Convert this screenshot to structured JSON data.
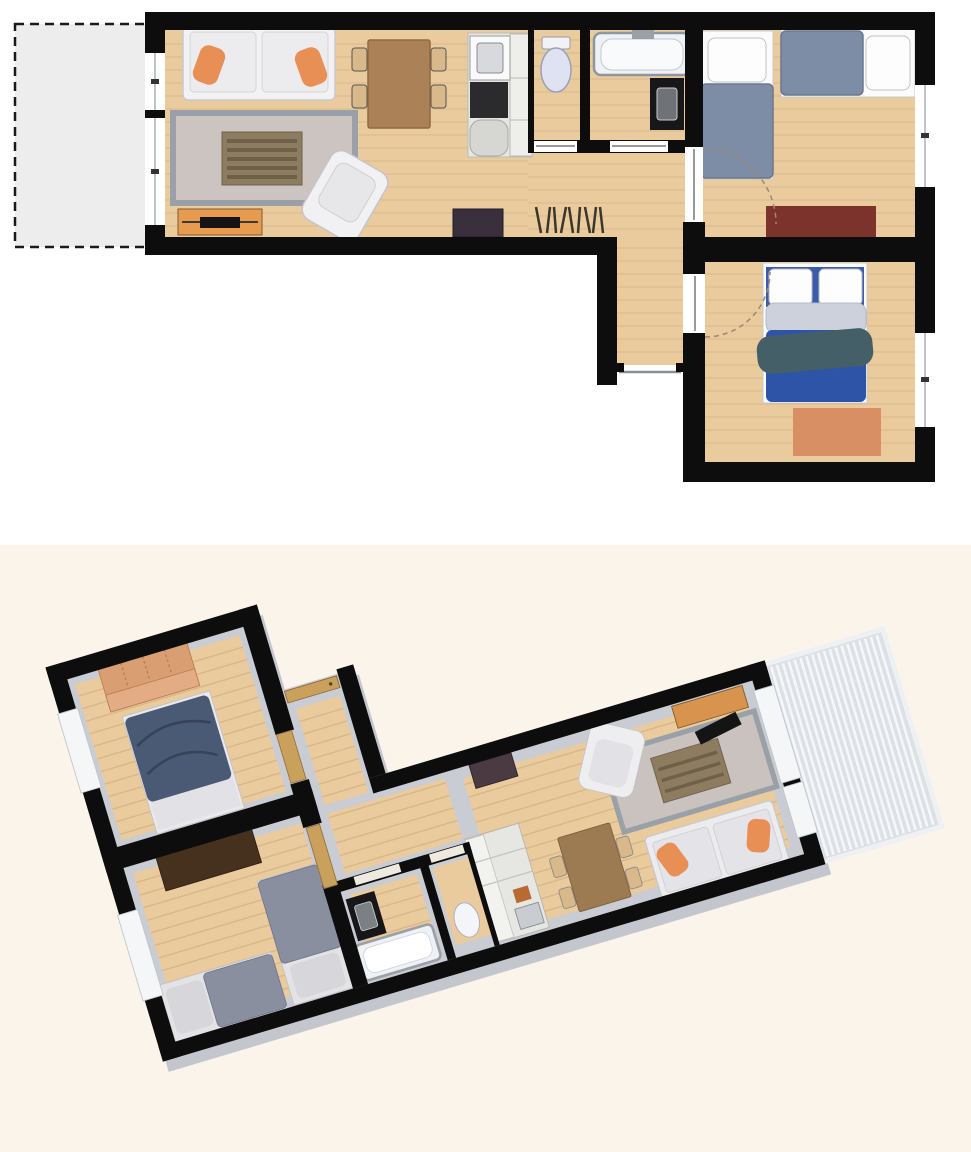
{
  "page": {
    "background_top": "#ffffff",
    "background_bottom": "#fbf4ea"
  },
  "colors": {
    "wall": "#0d0d0d",
    "wood": "#e9cb9e",
    "plank": "#d6b184",
    "balcony_2d": "#ededed",
    "balcony_3d": "#dce1e7",
    "balcony_stripe": "#f5f7f9",
    "floor_base_3d": "#c9ccd2",
    "extrusion_3d": "#c3c7cd",
    "window_white": "#ffffff",
    "rug_living": "#ccc4c1",
    "rug_border": "#9aa0a8",
    "coffee_table": "#8d7c5f",
    "sofa": "#f2f2f4",
    "pillow_orange": "#e88f55",
    "armchair": "#f1f1f3",
    "tv_stand": "#e89a4e",
    "tv_black": "#141414",
    "dining_table": "#ab8157",
    "chair": "#d9b98a",
    "kitchen_unit": "#e6e6e2",
    "cooktop": "#2b2b2d",
    "sideboard": "#3a2f3d",
    "toilet": "#dfe2f2",
    "bathtub": "#eef1f5",
    "vanity": "#17171a",
    "bed_single": "#7e8da6",
    "bed_double": "#2e54a8",
    "duvet": "#cdd1dc",
    "throw": "#455f68",
    "pillow_white": "#fdfdfe",
    "rug_kids": "#7b332c",
    "rug_master": "#d88f63",
    "bed_single_3d": "#8a8fa0",
    "bed_double_3d": "#4a5a75",
    "wardrobe_3d": "#d99e71",
    "dresser_3d": "#46311f",
    "door_wood": "#c9a05c"
  },
  "plan_2d": {
    "view": "top-down floor plan",
    "rooms": [
      {
        "name": "balcony",
        "furniture": []
      },
      {
        "name": "living-room",
        "furniture": [
          "sofa",
          "rug",
          "coffee-table",
          "armchair",
          "tv-stand",
          "dining-table",
          "sideboard",
          "coat-rack"
        ]
      },
      {
        "name": "kitchen",
        "furniture": [
          "kitchen-unit",
          "sink",
          "cooktop"
        ]
      },
      {
        "name": "wc",
        "furniture": [
          "toilet"
        ]
      },
      {
        "name": "bathroom",
        "furniture": [
          "bathtub",
          "vanity-sink"
        ]
      },
      {
        "name": "hallway",
        "furniture": [
          "entrance-door"
        ]
      },
      {
        "name": "kids-bedroom",
        "furniture": [
          "single-bed",
          "single-bed",
          "rug"
        ]
      },
      {
        "name": "master-bedroom",
        "furniture": [
          "double-bed",
          "rug"
        ]
      }
    ]
  },
  "plan_3d": {
    "view": "3d perspective floor plan",
    "rotation_deg": 163,
    "rooms": [
      {
        "name": "balcony",
        "furniture": [
          "deck"
        ]
      },
      {
        "name": "living-room",
        "furniture": [
          "sofa",
          "rug",
          "coffee-table",
          "armchair",
          "tv-stand",
          "dining-table",
          "sideboard"
        ]
      },
      {
        "name": "kitchen",
        "furniture": [
          "kitchen-unit",
          "sink",
          "cooktop"
        ]
      },
      {
        "name": "wc",
        "furniture": [
          "toilet"
        ]
      },
      {
        "name": "bathroom",
        "furniture": [
          "bathtub",
          "vanity-sink"
        ]
      },
      {
        "name": "hallway",
        "furniture": [
          "entrance-door"
        ]
      },
      {
        "name": "kids-bedroom",
        "furniture": [
          "single-bed",
          "single-bed",
          "dresser"
        ]
      },
      {
        "name": "master-bedroom",
        "furniture": [
          "double-bed",
          "wardrobe"
        ]
      }
    ]
  }
}
